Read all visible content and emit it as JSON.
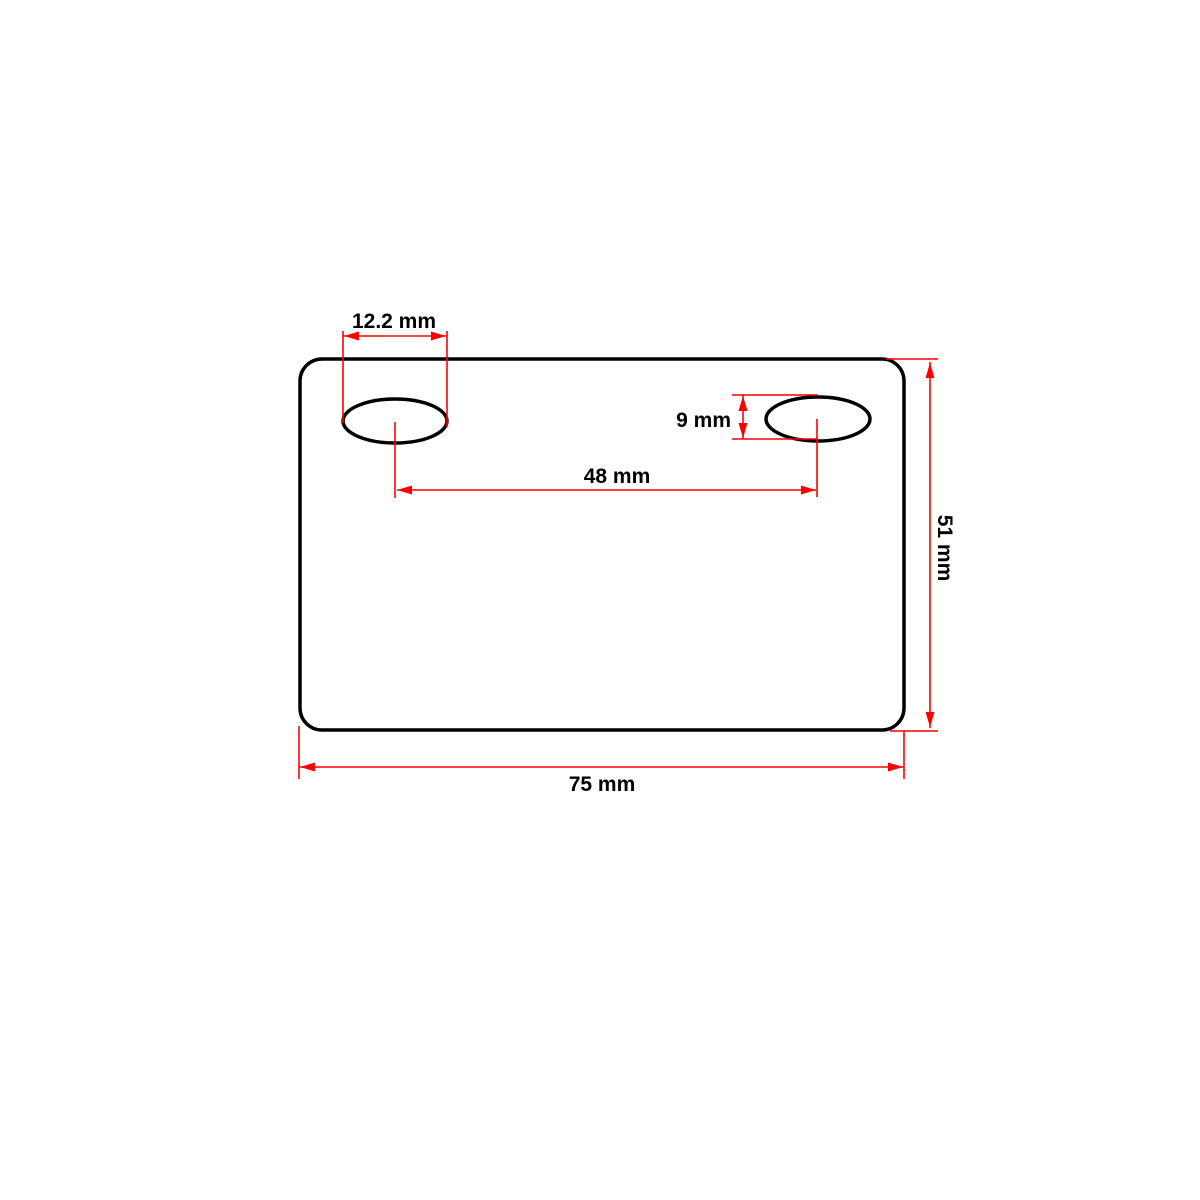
{
  "drawing": {
    "name": "rectangular-plate-with-two-oval-slots",
    "colors": {
      "outline": "#000000",
      "dimension": "#ff0000",
      "text": "#000000",
      "background": "#ffffff"
    }
  },
  "dimensions": {
    "slot_width": {
      "label": "12.2 mm",
      "value": 12.2,
      "unit": "mm"
    },
    "slot_height": {
      "label": "9 mm",
      "value": 9,
      "unit": "mm"
    },
    "slot_center_spacing": {
      "label": "48 mm",
      "value": 48,
      "unit": "mm"
    },
    "plate_height": {
      "label": "51 mm",
      "value": 51,
      "unit": "mm"
    },
    "plate_width": {
      "label": "75 mm",
      "value": 75,
      "unit": "mm"
    }
  }
}
